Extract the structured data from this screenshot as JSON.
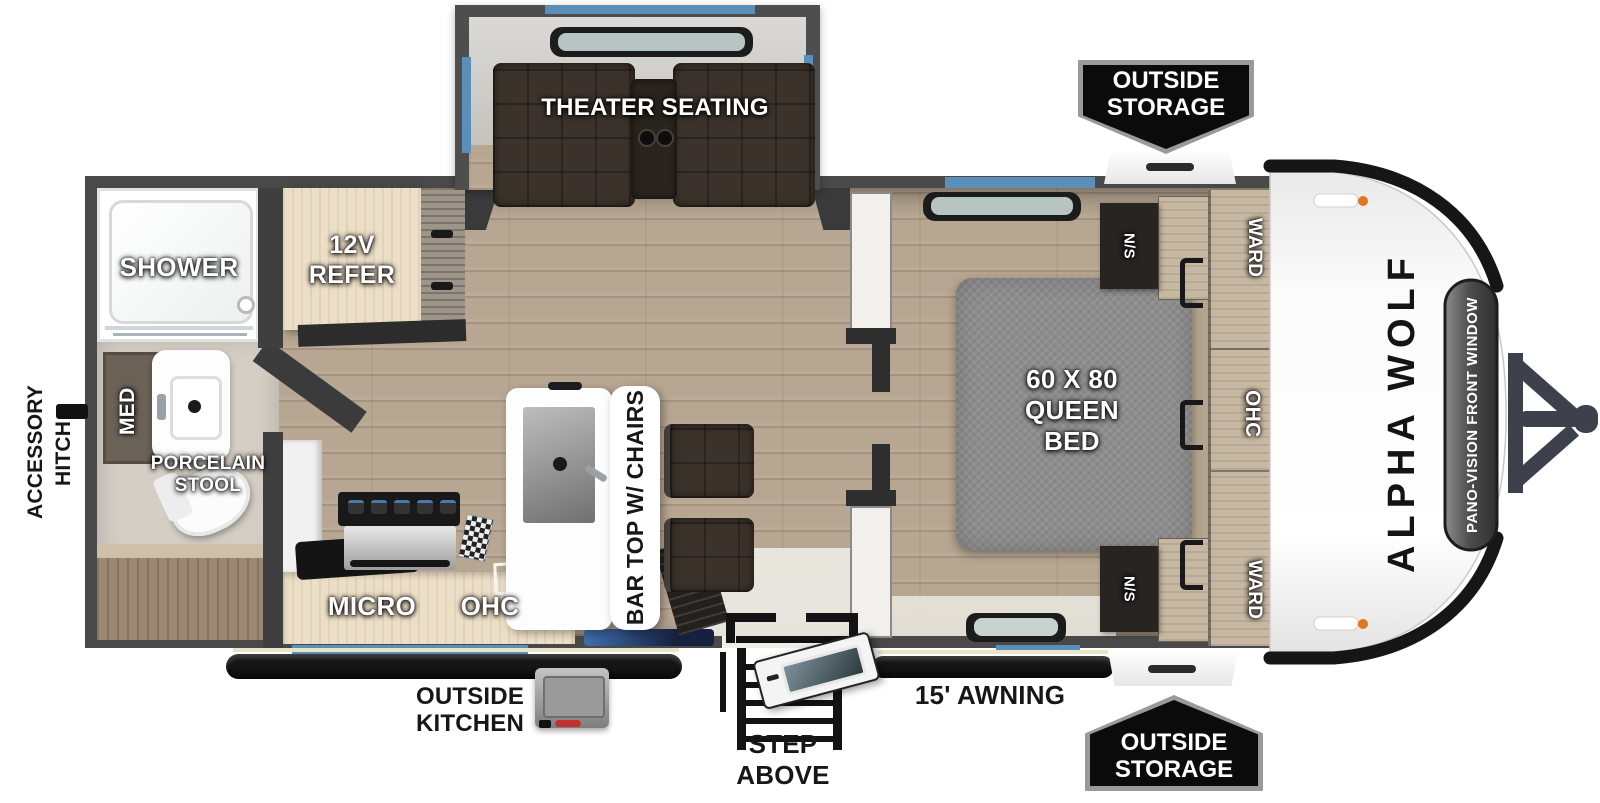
{
  "brand": {
    "model": "ALPHA WOLF",
    "front_window": "PANO-VISION FRONT WINDOW"
  },
  "labels": {
    "theater": "THEATER SEATING",
    "shower": "SHOWER",
    "refer_l1": "12V",
    "refer_l2": "REFER",
    "med": "MED",
    "stool_l1": "PORCELAIN",
    "stool_l2": "STOOL",
    "accessory_l1": "ACCESSORY",
    "accessory_l2": "HITCH",
    "micro": "MICRO",
    "ohc_kitchen": "OHC",
    "bartop": "BAR TOP W/ CHAIRS",
    "bed_l1": "60 X 80",
    "bed_l2": "QUEEN",
    "bed_l3": "BED",
    "ns": "N/S",
    "ward_top": "WARD",
    "ohc_bedroom": "OHC",
    "ward_bottom": "WARD",
    "storage_l1": "OUTSIDE",
    "storage_l2": "STORAGE",
    "out_kitchen_l1": "OUTSIDE",
    "out_kitchen_l2": "KITCHEN",
    "awning": "15' AWNING",
    "step_above": "STEP ABOVE"
  },
  "colors": {
    "accent_blue": "#5a8fb9",
    "wall_gray": "#494949",
    "floor_wood": "#b7a692",
    "cabinet_wood": "#ecdfc7",
    "seat_brown": "#3b332b",
    "mattress_gray": "#8e8e8e",
    "badge_black": "#0b0b0b",
    "marker_orange": "#e2761f"
  }
}
